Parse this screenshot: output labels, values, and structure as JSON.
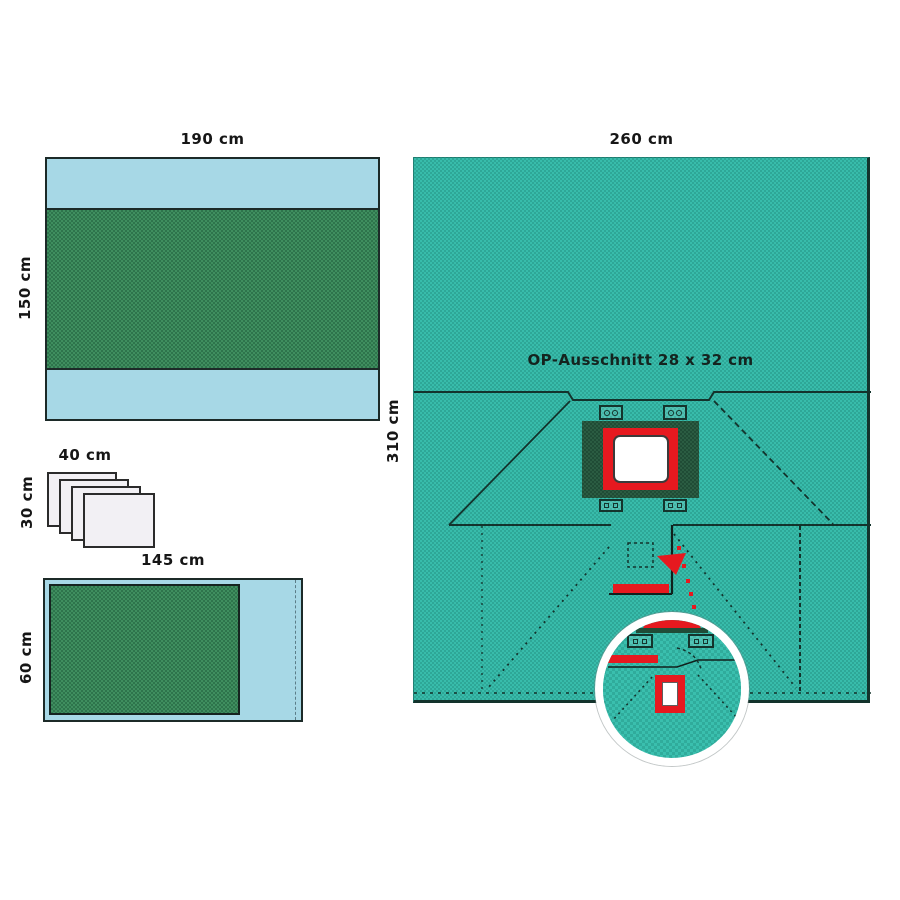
{
  "diagram": {
    "description": "Surgical drape set technical diagram",
    "labels": {
      "flat_drape": {
        "width": "190 cm",
        "height": "150 cm"
      },
      "towel_stack": {
        "width": "40 cm",
        "height": "30 cm",
        "count": 4
      },
      "side_drape": {
        "width": "145 cm",
        "height": "60 cm"
      },
      "main_drape": {
        "width": "260 cm",
        "height": "310 cm",
        "aperture": "OP-Ausschnitt 28 x 32 cm"
      }
    },
    "colors": {
      "teal_drape": "#38bcab",
      "green_absorbent": "#3f8e5f",
      "dark_green_incise": "#2b5c42",
      "light_blue": "#a7d8e6",
      "accent_red": "#e6191f",
      "line": "#13332c",
      "sheet_white": "#f2f0f4",
      "background": "#ffffff"
    }
  }
}
